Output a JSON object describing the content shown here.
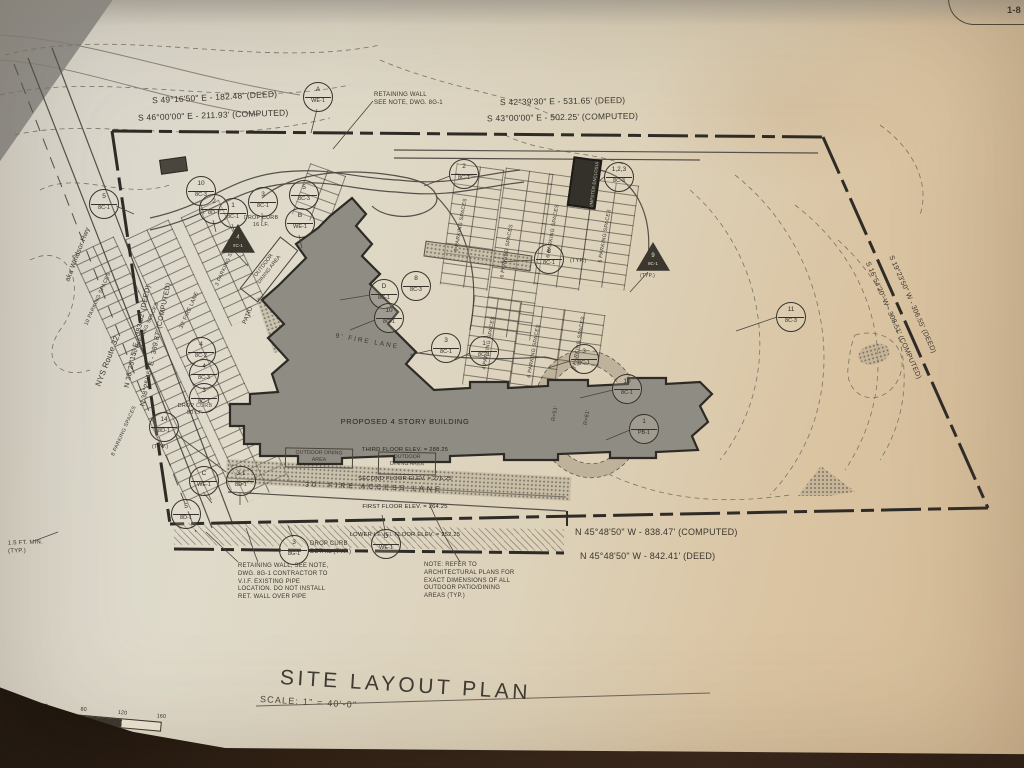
{
  "sheet": {
    "corner_ref": "1-8"
  },
  "title": {
    "text": "SITE LAYOUT PLAN",
    "scale": "SCALE: 1\" = 40'-0\""
  },
  "scale_bar": {
    "labels": [
      "40",
      "80",
      "120",
      "160"
    ],
    "caption": "SCALE: 1\" = 40'-0\""
  },
  "bearings": {
    "top_left": {
      "deed": "S 49°16'50\" E - 182.48' (DEED)",
      "computed": "S 46°00'00\" E - 211.93' (COMPUTED)"
    },
    "top_right": {
      "deed": "S 42°39'30\" E - 531.65' (DEED)",
      "computed": "S 43°00'00\" E - 502.25' (COMPUTED)"
    },
    "bottom": {
      "computed": "N 45°48'50\" W - 838.47' (COMPUTED)",
      "deed": "N 45°48'50\" W - 842.41' (DEED)"
    },
    "left": {
      "deed": "N 38°25'15\" E - 383.52' (DEED)",
      "computed": "N 38°25'45\" E - 389.87' (COMPUTED)"
    },
    "right": {
      "computed": "S 16°54'20\" W - 308.51' (COMPUTED)",
      "deed": "S 19°23'50\" W - 306.55' (DEED)"
    }
  },
  "roads": {
    "name": "NYS Route 32",
    "aka": "aka Windsor Hwy"
  },
  "building": {
    "title": "PROPOSED 4 STORY BUILDING",
    "floors": [
      "THIRD FLOOR ELEV. = 288.25",
      "SECOND FLOOR ELEV. = 276.25",
      "FIRST FLOOR ELEV. = 264.25",
      "LOWER LEVEL FLOOR ELEV. = 252.25"
    ]
  },
  "areas": {
    "outdoor_dining_1": "OUTDOOR DINING\nAREA",
    "outdoor_dining_2": "OUTDOOR\nDINING AREA",
    "outdoor_dining_rot": "OUTDOOR\nDINING AREA",
    "patio": "PATIO",
    "dumpster": "DUMPSTER ENCLOSURE",
    "radius_1": "R=51'",
    "radius_2": "R=61'"
  },
  "lanes": {
    "fire_lane_9": "9' FIRE LANE",
    "fire_lane_30": "30' FIRE LANE",
    "fire_access": "30' FIRE ACCESS LANE"
  },
  "notes": {
    "retaining_wall_top": "RETAINING WALL\nSEE NOTE, DWG. 8G-1",
    "retaining_wall_bottom": "RETAINING WALL, SEE NOTE,\nDWG. 8G-1 CONTRACTOR TO\nV.I.F. EXISTING PIPE\nLOCATION. DO NOT INSTALL\nRET. WALL OVER PIPE",
    "arch_note": "NOTE: REFER TO\nARCHITECTURAL PLANS FOR\nEXACT DIMENSIONS OF ALL\nOUTDOOR PATIO/DINING\nAREAS (TYP.)",
    "drop_curb_16": "DROP CURB\n16 LF.",
    "drop_curb_50": "DROP CURB\n50 LF.",
    "drop_curb_detail": "DROP CURB\nDETAIL (TYP.)",
    "min_typ": "1.5 FT. MIN.\n(TYP.)",
    "typ": "(TYP.)"
  },
  "parking_labels": [
    "10 PARKING SPACES",
    "10 PARKING SPACES",
    "8 PARKING SPACES",
    "3 PARKING SPACES",
    "9 PARKING SPACES",
    "6 PARKING SPACES",
    "6 PARKING SPACES",
    "5 PARKING SPACES",
    "4 PARKING SPACES",
    "6 PARKING SPACES",
    "5 PARKING SPACES"
  ],
  "callouts": [
    {
      "top": "A",
      "bottom": "WE-1"
    },
    {
      "top": "10",
      "bottom": "8C-3"
    },
    {
      "top": "3",
      "bottom": "8C-1"
    },
    {
      "top": "5",
      "bottom": "8C-3"
    },
    {
      "top": "1",
      "bottom": "8C-1"
    },
    {
      "top": "B",
      "bottom": "WE-1"
    },
    {
      "top": "5",
      "bottom": "8C-1"
    },
    {
      "top": "2",
      "bottom": "8D-1"
    },
    {
      "top": "2",
      "bottom": "8C-1"
    },
    {
      "top": "1,2,3",
      "bottom": "8C-3"
    },
    {
      "top": "8",
      "bottom": "8C-1"
    },
    {
      "top": "9",
      "bottom": "8C-1"
    },
    {
      "top": "D",
      "bottom": "8C-1"
    },
    {
      "top": "8",
      "bottom": "8C-3"
    },
    {
      "top": "10",
      "bottom": "8C-1"
    },
    {
      "top": "3",
      "bottom": "8C-1"
    },
    {
      "top": "1",
      "bottom": "8C-1"
    },
    {
      "top": "3",
      "bottom": "8C-1"
    },
    {
      "top": "10",
      "bottom": "8C-1"
    },
    {
      "top": "1",
      "bottom": "PB-1"
    },
    {
      "top": "11",
      "bottom": "8C-3"
    },
    {
      "top": "4",
      "bottom": "8C-1"
    },
    {
      "top": "4",
      "bottom": "8C-2"
    },
    {
      "top": "4",
      "bottom": "8C-3"
    },
    {
      "top": "3",
      "bottom": "8C-1"
    },
    {
      "top": "14",
      "bottom": "8D-1"
    },
    {
      "top": "C",
      "bottom": "WE-1"
    },
    {
      "top": "3,1",
      "bottom": "8D-1"
    },
    {
      "top": "5",
      "bottom": "8D-1"
    },
    {
      "top": "3",
      "bottom": "8G-1"
    },
    {
      "top": "D",
      "bottom": "WE-1"
    }
  ]
}
